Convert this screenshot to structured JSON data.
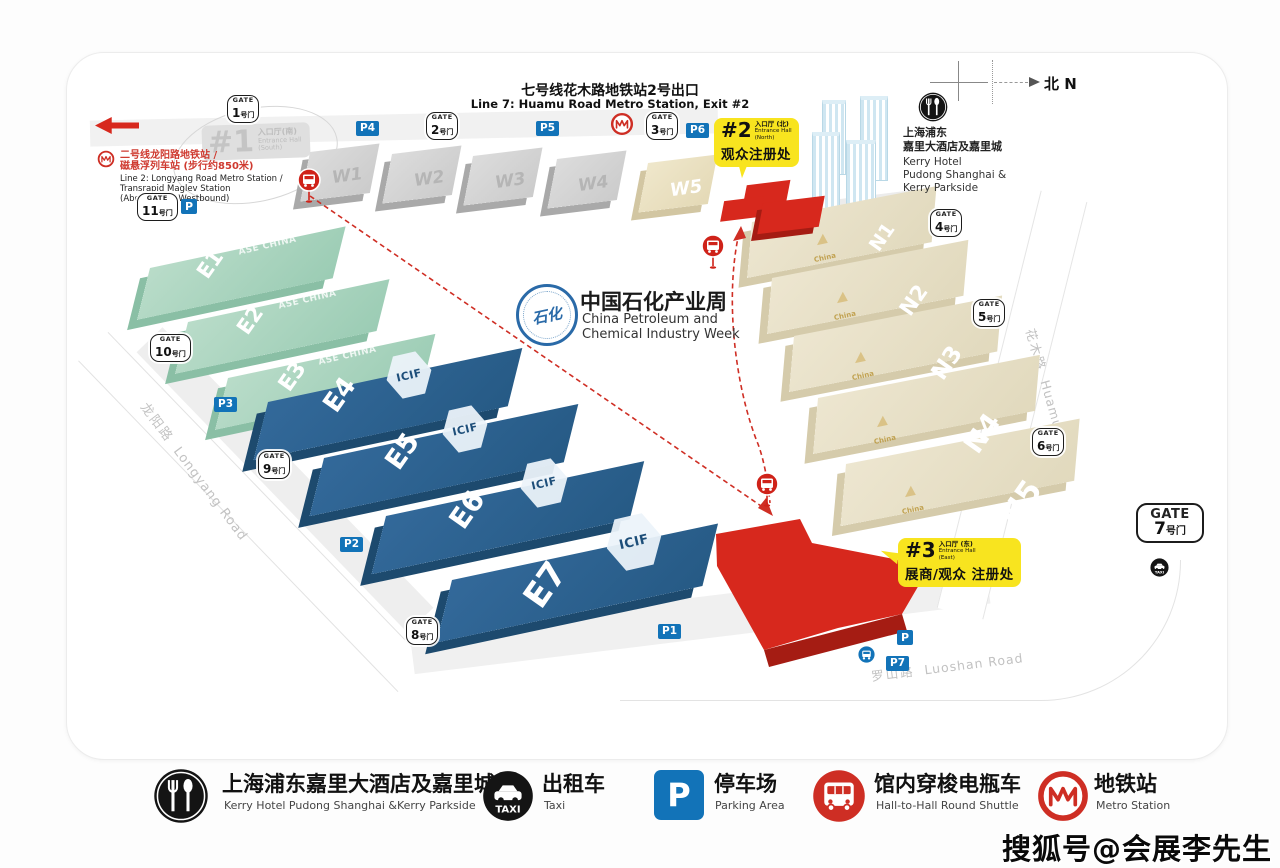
{
  "colors": {
    "accent_red": "#d7281d",
    "dark_red": "#a51c13",
    "callout_yellow": "#f8e41f",
    "hall_blue": "#2d6390",
    "hall_green": "#a9d4bf",
    "hall_beige": "#e9e2cb",
    "hall_gray": "#d6d6d6",
    "parking_blue": "#1273b8",
    "metro_red": "#ce2e24",
    "logo_blue": "#2a6aa8"
  },
  "page": {
    "top_note": {
      "zh": "七号线花木路地铁站2号出口",
      "en": "Line 7: Huamu Road Metro Station, Exit #2"
    },
    "compass_label": "北 N",
    "watermark": "搜狐号@会展李先生"
  },
  "event": {
    "logo_inner": "石化",
    "title_zh": "中国石化产业周",
    "title_en1": "China Petroleum and",
    "title_en2": "Chemical Industry Week"
  },
  "metro_note": {
    "zh1": "二号线龙阳路地铁站 /",
    "zh2": "磁悬浮列车站 (步行约850米)",
    "en1": "Line 2: Longyang Road Metro Station /",
    "en2": "Transrapid Maglev Station",
    "en3": "(About 850m Westbound)"
  },
  "entrance1": {
    "num": "#1",
    "zh": "入口厅(南)",
    "en1": "Entrance Hall",
    "en2": "(South)"
  },
  "entrance2": {
    "num": "#2",
    "zh": "入口厅 (北)",
    "en1": "Entrance Hall",
    "en2": "(North)",
    "reg": "观众注册处"
  },
  "entrance3": {
    "num": "#3",
    "zh": "入口厅 (东)",
    "en1": "Entrance Hall",
    "en2": "(East)",
    "reg": "展商/观众 注册处"
  },
  "hotel_note": {
    "zh1": "上海浦东",
    "zh2": "嘉里大酒店及嘉里城",
    "en1": "Kerry Hotel",
    "en2": "Pudong Shanghai &",
    "en3": "Kerry Parkside"
  },
  "gates": {
    "word": "GATE",
    "suffix": "号门",
    "n1": "1",
    "n2": "2",
    "n3": "3",
    "n4": "4",
    "n5": "5",
    "n6": "6",
    "n7": "7",
    "n8": "8",
    "n9": "9",
    "n10": "10",
    "n11": "11"
  },
  "parking": {
    "p": "P",
    "p1": "P1",
    "p2": "P2",
    "p3": "P3",
    "p4": "P4",
    "p5": "P5",
    "p6": "P6",
    "p7": "P7"
  },
  "halls": {
    "w": [
      "W1",
      "W2",
      "W3",
      "W4",
      "W5"
    ],
    "e": [
      "E1",
      "E2",
      "E3",
      "E4",
      "E5",
      "E6",
      "E7"
    ],
    "n": [
      "N1",
      "N2",
      "N3",
      "N4",
      "N5"
    ],
    "green_watermark": "ASE CHINA",
    "blue_logo": "ICIF",
    "n_logo": "China"
  },
  "roads": {
    "longyang_zh": "龙阳路",
    "longyang_en": "Longyang Road",
    "huamu_zh": "花木路",
    "huamu_en": "Huamu Road",
    "luoshan_zh": "罗山路",
    "luoshan_en": "Luoshan Road"
  },
  "legend": {
    "taxi_text": "TAXI",
    "items": [
      {
        "zh": "上海浦东嘉里大酒店及嘉里城",
        "en": "Kerry Hotel Pudong Shanghai &Kerry Parkside"
      },
      {
        "zh": "出租车",
        "en": "Taxi"
      },
      {
        "zh": "停车场",
        "en": "Parking Area"
      },
      {
        "zh": "馆内穿梭电瓶车",
        "en": "Hall-to-Hall Round Shuttle"
      },
      {
        "zh": "地铁站",
        "en": "Metro Station"
      }
    ]
  }
}
